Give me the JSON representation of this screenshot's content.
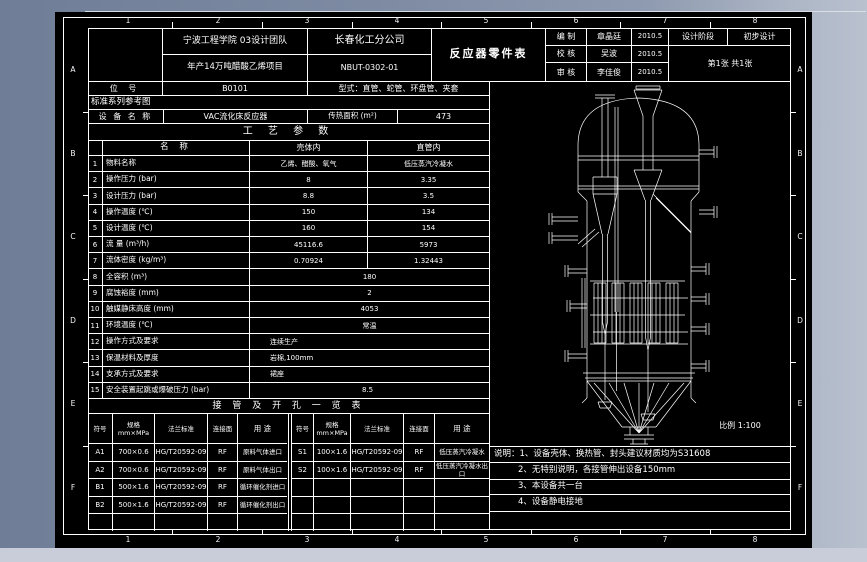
{
  "canvas": {
    "sheet_bg": "#000000",
    "line_color": "#ffffff",
    "bg_left": "#6f7d97",
    "bg_right": "#b9c1cf",
    "bottom_strip": "#c9cdd9"
  },
  "border": {
    "col_numbers": [
      "1",
      "2",
      "3",
      "4",
      "5",
      "6",
      "7",
      "8"
    ],
    "row_letters": [
      "A",
      "B",
      "C",
      "D",
      "E",
      "F"
    ]
  },
  "title_block": {
    "org_line1": "宁波工程学院 03设计团队",
    "org_line2": "年产14万吨醋酸乙烯项目",
    "company": "长春化工分公司",
    "drawing_no": "NBUT-0302-01",
    "sheet_title": "反应器零件表",
    "sign_rows": [
      {
        "role": "编 制",
        "name": "章晶廷",
        "date": "2010.5"
      },
      {
        "role": "校 核",
        "name": "吴波",
        "date": "2010.5"
      },
      {
        "role": "审 核",
        "name": "李佳俊",
        "date": "2010.5"
      }
    ],
    "stage_label": "设计阶段",
    "stage_value": "初步设计",
    "sheet_info": "第1张  共1张"
  },
  "info": {
    "tag_label": "位  号",
    "tag_value": "B0101",
    "type_text": "型式：直管、蛇管、环盘管、夹套",
    "std_series": "标准系列参考图",
    "equip_label": "设 备 名 称",
    "equip_value": "VAC流化床反应器",
    "area_label": "传热面积 (m²)",
    "area_value": "473"
  },
  "process_table": {
    "title": "工 艺 参 数",
    "headers": {
      "name": "名  称",
      "shell": "壳体内",
      "tube": "直管内"
    },
    "rows": [
      {
        "no": "1",
        "name": "物料名称",
        "shell": "乙烯、醋酸、氧气",
        "tube": "低压蒸汽冷凝水"
      },
      {
        "no": "2",
        "name": "操作压力 (bar)",
        "shell": "8",
        "tube": "3.35"
      },
      {
        "no": "3",
        "name": "设计压力 (bar)",
        "shell": "8.8",
        "tube": "3.5"
      },
      {
        "no": "4",
        "name": "操作温度 (℃)",
        "shell": "150",
        "tube": "134"
      },
      {
        "no": "5",
        "name": "设计温度 (℃)",
        "shell": "160",
        "tube": "154"
      },
      {
        "no": "6",
        "name": "流  量 (m³/h)",
        "shell": "45116.6",
        "tube": "5973"
      },
      {
        "no": "7",
        "name": "流体密度 (kg/m³)",
        "shell": "0.70924",
        "tube": "1.32443"
      },
      {
        "no": "8",
        "name": "全容积 (m³)",
        "span": "180"
      },
      {
        "no": "9",
        "name": "腐蚀裕度 (mm)",
        "span": "2"
      },
      {
        "no": "10",
        "name": "触媒静床高度 (mm)",
        "span": "4053"
      },
      {
        "no": "11",
        "name": "环境温度 (℃)",
        "span": "常温"
      },
      {
        "no": "12",
        "name": "操作方式及要求",
        "span": "连续生产",
        "align": "left"
      },
      {
        "no": "13",
        "name": "保温材料及厚度",
        "span": "岩棉,100mm",
        "align": "left"
      },
      {
        "no": "14",
        "name": "支承方式及要求",
        "span": "裙座",
        "align": "left"
      },
      {
        "no": "15",
        "name": "安全装置起跳或爆破压力 (bar)",
        "span": "8.5",
        "align": "indent"
      }
    ]
  },
  "nozzle_table": {
    "title": "接 管 及 开 孔 一 览 表",
    "headers": [
      "符号",
      "规格\nmm×MPa",
      "法兰标准",
      "连接面",
      "用  途"
    ],
    "left_rows": [
      [
        "A1",
        "700×0.6",
        "HG/T20592-09",
        "RF",
        "原料气体进口"
      ],
      [
        "A2",
        "700×0.6",
        "HG/T20592-09",
        "RF",
        "原料气体出口"
      ],
      [
        "B1",
        "500×1.6",
        "HG/T20592-09",
        "RF",
        "循环催化剂进口"
      ],
      [
        "B2",
        "500×1.6",
        "HG/T20592-09",
        "RF",
        "循环催化剂出口"
      ]
    ],
    "right_rows": [
      [
        "S1",
        "100×1.6",
        "HG/T20592-09",
        "RF",
        "低压蒸汽冷凝水"
      ],
      [
        "S2",
        "100×1.6",
        "HG/T20592-09",
        "RF",
        "低压蒸汽冷凝水出口"
      ]
    ]
  },
  "drawing": {
    "scale_label": "比例  1:100"
  },
  "notes": [
    "说明：1、设备壳体、换热管、封头建议材质均为S31608",
    "2、无特别说明，各接管伸出设备150mm",
    "3、本设备共一台",
    "4、设备静电接地"
  ]
}
